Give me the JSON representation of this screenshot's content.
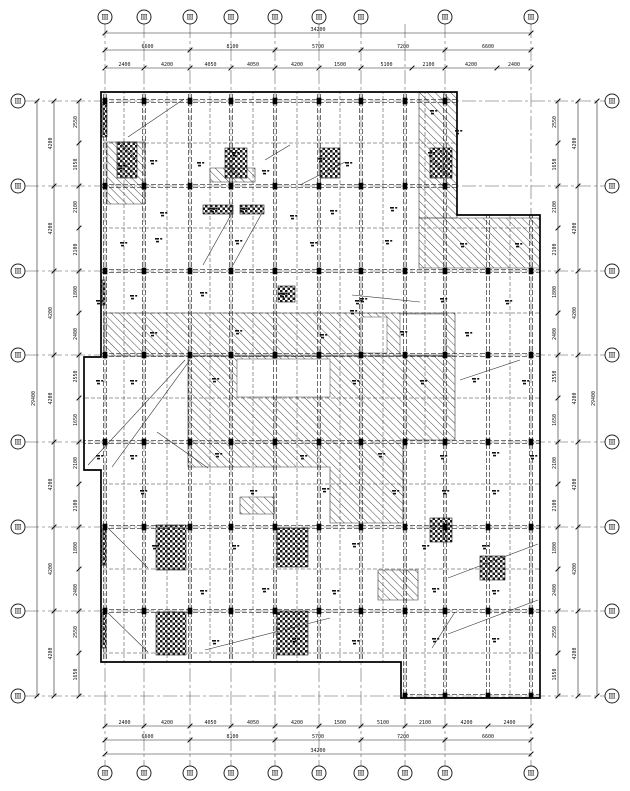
{
  "meta": {
    "drawing_type": "structural floor framing plan",
    "background": "#ffffff",
    "line_color": "#1c1c1c",
    "sheet_width": 630,
    "sheet_height": 791
  },
  "axis_bubbles": {
    "top": {
      "cy": 17,
      "r": 7,
      "xs": [
        105,
        144,
        190,
        231,
        275,
        319,
        361,
        445,
        531
      ],
      "labels": [
        "Ⅲ",
        "Ⅲ",
        "Ⅲ",
        "Ⅲ",
        "Ⅲ",
        "Ⅲ",
        "Ⅲ",
        "Ⅲ",
        "Ⅲ"
      ]
    },
    "bottom": {
      "cy": 773,
      "r": 7,
      "xs": [
        105,
        144,
        190,
        231,
        275,
        319,
        361,
        405,
        445,
        531
      ],
      "labels": [
        "Ⅲ",
        "Ⅲ",
        "Ⅲ",
        "Ⅲ",
        "Ⅲ",
        "Ⅲ",
        "Ⅲ",
        "Ⅲ",
        "Ⅲ",
        "Ⅲ"
      ]
    },
    "left": {
      "cx": 18,
      "r": 7,
      "ys": [
        101,
        186,
        271,
        355,
        442,
        527,
        611,
        696
      ],
      "labels": [
        "Ⅲ",
        "Ⅲ",
        "Ⅲ",
        "Ⅲ",
        "Ⅲ",
        "Ⅲ",
        "Ⅲ",
        "Ⅲ"
      ]
    },
    "right": {
      "cx": 612,
      "r": 7,
      "ys": [
        101,
        186,
        271,
        355,
        442,
        527,
        611,
        696
      ],
      "labels": [
        "Ⅲ",
        "Ⅲ",
        "Ⅲ",
        "Ⅲ",
        "Ⅲ",
        "Ⅲ",
        "Ⅲ",
        "Ⅲ"
      ]
    }
  },
  "dimension_rows": [
    {
      "name": "dim-top-total",
      "orient": "h",
      "pos": 33,
      "ticks": [
        105,
        531
      ],
      "values": [
        "34200"
      ]
    },
    {
      "name": "dim-top-bays",
      "orient": "h",
      "pos": 50,
      "ticks": [
        105,
        190,
        275,
        361,
        445,
        531
      ],
      "values": [
        "6600",
        "8100",
        "5700",
        "7200",
        "6600"
      ]
    },
    {
      "name": "dim-top-sub",
      "orient": "h",
      "pos": 68,
      "ticks": [
        105,
        144,
        190,
        231,
        275,
        319,
        361,
        412,
        445,
        497,
        531
      ],
      "values": [
        "2400",
        "4200",
        "4050",
        "4050",
        "4200",
        "1500",
        "5100",
        "2100",
        "4200",
        "2400"
      ]
    },
    {
      "name": "dim-bottom-sub",
      "orient": "h",
      "pos": 726,
      "ticks": [
        105,
        144,
        190,
        231,
        275,
        319,
        361,
        405,
        445,
        488,
        531
      ],
      "values": [
        "2400",
        "4200",
        "4050",
        "4050",
        "4200",
        "1500",
        "5100",
        "2100",
        "4200",
        "2400"
      ]
    },
    {
      "name": "dim-bottom-bays",
      "orient": "h",
      "pos": 740,
      "ticks": [
        105,
        190,
        275,
        361,
        445,
        531
      ],
      "values": [
        "6600",
        "8100",
        "5700",
        "7200",
        "6600"
      ]
    },
    {
      "name": "dim-bottom-total",
      "orient": "h",
      "pos": 754,
      "ticks": [
        105,
        531
      ],
      "values": [
        "34200"
      ]
    },
    {
      "name": "dim-left-total",
      "orient": "v",
      "pos": 37,
      "ticks": [
        101,
        696
      ],
      "values": [
        "29400"
      ]
    },
    {
      "name": "dim-left-bays",
      "orient": "v",
      "pos": 54,
      "ticks": [
        101,
        186,
        271,
        355,
        442,
        527,
        611,
        696
      ],
      "values": [
        "4200",
        "4200",
        "4200",
        "4200",
        "4200",
        "4200",
        "4200"
      ]
    },
    {
      "name": "dim-left-sub",
      "orient": "v",
      "pos": 79,
      "ticks": [
        101,
        143,
        186,
        228,
        271,
        313,
        355,
        398,
        442,
        484,
        527,
        569,
        611,
        653,
        696
      ],
      "values": [
        "2550",
        "1650",
        "2100",
        "2100",
        "1800",
        "2400",
        "2550",
        "1650",
        "2100",
        "2100",
        "1800",
        "2400",
        "2550",
        "1650"
      ]
    },
    {
      "name": "dim-right-sub",
      "orient": "v",
      "pos": 558,
      "ticks": [
        101,
        143,
        186,
        228,
        271,
        313,
        355,
        398,
        442,
        484,
        527,
        569,
        611,
        653,
        696
      ],
      "values": [
        "2550",
        "1650",
        "2100",
        "2100",
        "1800",
        "2400",
        "2550",
        "1650",
        "2100",
        "2100",
        "1800",
        "2400",
        "2550",
        "1650"
      ]
    },
    {
      "name": "dim-right-bays",
      "orient": "v",
      "pos": 578,
      "ticks": [
        101,
        186,
        271,
        355,
        442,
        527,
        611,
        696
      ],
      "values": [
        "4200",
        "4200",
        "4200",
        "4200",
        "4200",
        "4200",
        "4200"
      ]
    },
    {
      "name": "dim-right-total",
      "orient": "v",
      "pos": 597,
      "ticks": [
        101,
        696
      ],
      "values": [
        "29400"
      ]
    }
  ],
  "grid": {
    "vx": [
      105,
      144,
      190,
      231,
      275,
      319,
      361,
      405,
      445,
      531
    ],
    "hy": [
      101,
      186,
      271,
      355,
      442,
      527,
      611,
      696
    ],
    "v_extent": [
      24,
      766
    ],
    "h_extent": [
      25,
      605
    ]
  },
  "building": {
    "outline": "M101,92 L457,92 L457,215 L540,215 L540,698 L401,698 L401,662 L101,662 L101,470 L84,470 L84,357 L101,357 Z"
  },
  "beams": {
    "vx": [
      105,
      144,
      190,
      231,
      275,
      319,
      361,
      405,
      445,
      488,
      531
    ],
    "vx_minor": [
      124,
      167,
      210,
      253,
      297,
      340,
      383,
      425,
      510
    ],
    "hy": [
      101,
      186,
      271,
      355,
      442,
      527,
      611,
      696
    ],
    "hy_minor": [
      143,
      228,
      313,
      398,
      484,
      569,
      653
    ]
  },
  "hatch_diag": [
    {
      "points": "104,313 455,313 455,356 104,356"
    },
    {
      "points": "188,356 455,356 455,440 403,440 403,523 330,523 330,467 188,467"
    },
    {
      "points": "419,92 457,92 457,218 419,218"
    },
    {
      "points": "419,218 540,218 540,268 419,268"
    },
    {
      "points": "107,142 145,142 145,204 107,204"
    },
    {
      "points": "210,168 255,168 255,182 210,182"
    },
    {
      "points": "240,497 274,497 274,514 240,514"
    },
    {
      "points": "378,570 418,570 418,600 378,600"
    }
  ],
  "hatch_cross": [
    {
      "x": 95,
      "y": 104,
      "w": 12,
      "h": 33
    },
    {
      "x": 117,
      "y": 142,
      "w": 20,
      "h": 36
    },
    {
      "x": 225,
      "y": 148,
      "w": 22,
      "h": 30
    },
    {
      "x": 320,
      "y": 148,
      "w": 20,
      "h": 30
    },
    {
      "x": 430,
      "y": 148,
      "w": 22,
      "h": 30
    },
    {
      "x": 92,
      "y": 280,
      "w": 13,
      "h": 25
    },
    {
      "x": 278,
      "y": 286,
      "w": 17,
      "h": 16
    },
    {
      "x": 203,
      "y": 205,
      "w": 30,
      "h": 9
    },
    {
      "x": 240,
      "y": 205,
      "w": 24,
      "h": 9
    },
    {
      "x": 93,
      "y": 530,
      "w": 13,
      "h": 35
    },
    {
      "x": 156,
      "y": 525,
      "w": 30,
      "h": 45
    },
    {
      "x": 277,
      "y": 528,
      "w": 31,
      "h": 39
    },
    {
      "x": 93,
      "y": 614,
      "w": 13,
      "h": 34
    },
    {
      "x": 156,
      "y": 612,
      "w": 30,
      "h": 43
    },
    {
      "x": 277,
      "y": 611,
      "w": 31,
      "h": 44
    },
    {
      "x": 430,
      "y": 518,
      "w": 22,
      "h": 24
    },
    {
      "x": 480,
      "y": 556,
      "w": 25,
      "h": 24
    }
  ],
  "white_insets": [
    {
      "x": 237,
      "y": 359,
      "w": 93,
      "h": 38
    },
    {
      "x": 361,
      "y": 317,
      "w": 26,
      "h": 36
    },
    {
      "x": 400,
      "y": 314,
      "w": 45,
      "h": 41
    }
  ],
  "leaders": [
    [
      128,
      137,
      184,
      99
    ],
    [
      112,
      467,
      190,
      360
    ],
    [
      88,
      465,
      185,
      360
    ],
    [
      203,
      265,
      232,
      213
    ],
    [
      233,
      265,
      262,
      213
    ],
    [
      108,
      528,
      148,
      568
    ],
    [
      108,
      613,
      148,
      652
    ],
    [
      205,
      650,
      330,
      618
    ],
    [
      448,
      578,
      538,
      544
    ],
    [
      448,
      634,
      538,
      600
    ],
    [
      352,
      295,
      420,
      302
    ],
    [
      157,
      432,
      208,
      468
    ],
    [
      432,
      648,
      455,
      612
    ],
    [
      265,
      160,
      290,
      145
    ],
    [
      345,
      162,
      300,
      185
    ],
    [
      460,
      380,
      520,
      360
    ]
  ],
  "marks": [
    [
      150,
      160
    ],
    [
      232,
      152
    ],
    [
      318,
      158
    ],
    [
      428,
      152
    ],
    [
      118,
      165
    ],
    [
      197,
      162
    ],
    [
      262,
      170
    ],
    [
      345,
      162
    ],
    [
      210,
      208
    ],
    [
      240,
      208
    ],
    [
      160,
      212
    ],
    [
      290,
      215
    ],
    [
      330,
      210
    ],
    [
      390,
      207
    ],
    [
      120,
      242
    ],
    [
      155,
      238
    ],
    [
      235,
      240
    ],
    [
      310,
      242
    ],
    [
      385,
      240
    ],
    [
      460,
      243
    ],
    [
      515,
      243
    ],
    [
      130,
      295
    ],
    [
      200,
      292
    ],
    [
      280,
      293
    ],
    [
      360,
      298
    ],
    [
      440,
      298
    ],
    [
      505,
      300
    ],
    [
      150,
      332
    ],
    [
      235,
      330
    ],
    [
      320,
      334
    ],
    [
      400,
      331
    ],
    [
      465,
      332
    ],
    [
      130,
      380
    ],
    [
      212,
      378
    ],
    [
      352,
      380
    ],
    [
      420,
      380
    ],
    [
      472,
      378
    ],
    [
      522,
      380
    ],
    [
      355,
      300
    ],
    [
      350,
      310
    ],
    [
      96,
      300
    ],
    [
      96,
      380
    ],
    [
      96,
      455
    ],
    [
      455,
      130
    ],
    [
      430,
      110
    ],
    [
      130,
      455
    ],
    [
      215,
      453
    ],
    [
      300,
      455
    ],
    [
      378,
      453
    ],
    [
      440,
      455
    ],
    [
      492,
      452
    ],
    [
      530,
      455
    ],
    [
      140,
      490
    ],
    [
      250,
      490
    ],
    [
      322,
      488
    ],
    [
      392,
      490
    ],
    [
      442,
      490
    ],
    [
      492,
      490
    ],
    [
      152,
      545
    ],
    [
      232,
      545
    ],
    [
      352,
      543
    ],
    [
      422,
      545
    ],
    [
      482,
      545
    ],
    [
      200,
      590
    ],
    [
      262,
      588
    ],
    [
      332,
      590
    ],
    [
      432,
      588
    ],
    [
      492,
      590
    ],
    [
      212,
      640
    ],
    [
      292,
      638
    ],
    [
      352,
      640
    ],
    [
      432,
      638
    ],
    [
      492,
      638
    ]
  ]
}
